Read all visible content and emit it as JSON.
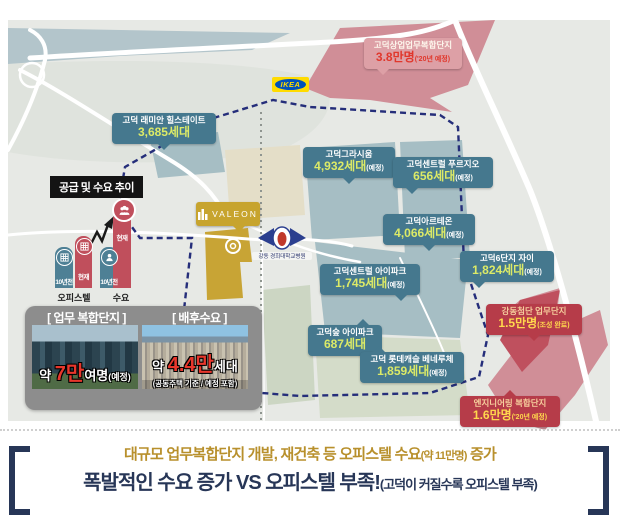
{
  "map": {
    "title_badge": "공급 및 수요 추이",
    "trend_chart": {
      "group1": "오피스텔",
      "group2": "수요",
      "past": "10년전",
      "now": "현재"
    },
    "complexes": [
      {
        "name": "고덕 래미안 힐스테이트",
        "units": "3,685세대",
        "suffix": ""
      },
      {
        "name": "고덕그라시움",
        "units": "4,932세대",
        "suffix": "(예정)"
      },
      {
        "name": "고덕센트럴 푸르지오",
        "units": "656세대",
        "suffix": "(예정)"
      },
      {
        "name": "고덕아르테온",
        "units": "4,066세대",
        "suffix": "(예정)"
      },
      {
        "name": "고덕6단지 자이",
        "units": "1,824세대",
        "suffix": "(예정)"
      },
      {
        "name": "고덕센트럴 아이파크",
        "units": "1,745세대",
        "suffix": "(예정)"
      },
      {
        "name": "고덕숲 아이파크",
        "units": "687세대",
        "suffix": ""
      },
      {
        "name": "고덕 롯데캐슬 베네루체",
        "units": "1,859세대",
        "suffix": "(예정)"
      }
    ],
    "business": [
      {
        "name": "고덕상업업무복합단지",
        "value": "3.8만명",
        "suffix": "('20년 예정)"
      },
      {
        "name": "강동첨단 업무단지",
        "value": "1.5만명",
        "suffix": "(조성 완료)"
      },
      {
        "name": "엔지니어링 복합단지",
        "value": "1.6만명",
        "suffix": "('20년 예정)"
      }
    ],
    "pois": {
      "ikea": "IKEA",
      "valeon": "VALEON",
      "hospital": "강동 경희대학교병원"
    }
  },
  "panel": {
    "left_title": "[ 업무 복합단지 ]",
    "right_title": "[ 배후수요 ]",
    "left_cap": {
      "p1": "약 ",
      "big": "7만",
      "p2": "여명",
      "p3": "(예정)"
    },
    "right_cap": {
      "p1": "약 ",
      "big": "4.4만",
      "p2": "세대",
      "note": "(공동주택 기준 / 예정 포함)"
    }
  },
  "footer": {
    "line1": {
      "text": "대규모 업무복합단지 개발, 재건축 등 오피스텔 수요",
      "small": "(약 11만명)",
      "tail": " 증가"
    },
    "line2": {
      "text": "폭발적인 수요 증가 VS 오피스텔 부족!",
      "small": "(고덕이 커질수록 오피스텔 부족)"
    }
  },
  "colors": {
    "teal_box": "#45788e",
    "red_box": "#b63c49",
    "pink_box": "#dda0a6",
    "unit_number": "#dcea67",
    "value_yellow": "#ffd84d",
    "pink_zone": "#d08e97",
    "gold_site": "#c8a435",
    "boundary_navy": "#252e7a",
    "footer_gold": "#b8902c",
    "footer_navy": "#273657"
  }
}
